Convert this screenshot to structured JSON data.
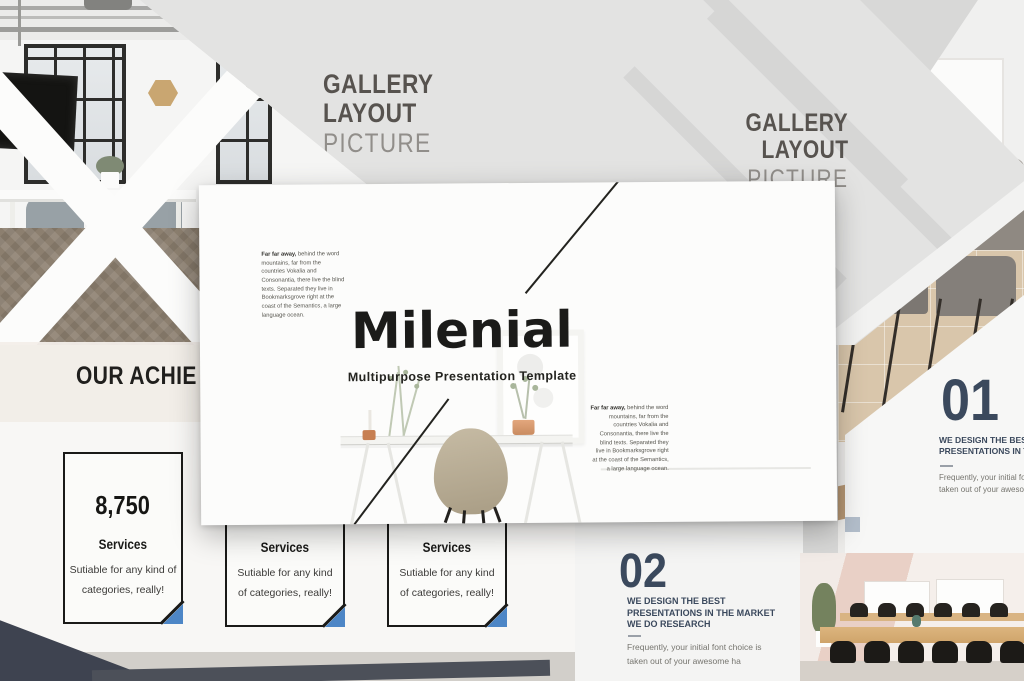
{
  "collage": {
    "gallery_left": {
      "line1": "GALLERY",
      "line2": "LAYOUT",
      "line3": "PICTURE"
    },
    "gallery_right": {
      "line1": "GALLERY",
      "line2": "LAYOUT",
      "line3": "PICTURE"
    },
    "main": {
      "title": "Milenial",
      "subtitle": "Multipurpose Presentation Template",
      "para_lead": "Far far away,",
      "para_body": " behind the word mountains, far from the countries Vokalia and Consonantia, there live the blind texts. Separated they live in Bookmarksgrove right at the coast of the Semantics, a large language ocean."
    },
    "achievements": {
      "title": "OUR ACHIE",
      "cards": [
        {
          "number": "8,750",
          "heading": "Services",
          "line1": "Sutiable for any kind of",
          "line2": "categories, really!"
        },
        {
          "heading": "Services",
          "line1": "Sutiable for any kind",
          "line2": "of categories, really!"
        },
        {
          "heading": "Services",
          "line1": "Sutiable for any kind",
          "line2": "of categories, really!"
        }
      ]
    },
    "block01": {
      "number": "01",
      "h1": "WE DESIGN THE BEST",
      "h2": "PRESENTATIONS IN THE",
      "b1": "Frequently, your initial font choice",
      "b2": "taken out of your awesome ha"
    },
    "block02": {
      "number": "02",
      "h1": "WE DESIGN THE BEST",
      "h2": "PRESENTATIONS IN THE MARKET",
      "h3": "WE DO RESEARCH",
      "b1": "Frequently, your initial font choice is",
      "b2": "taken out of your awesome ha"
    },
    "colors": {
      "accent_blue": "#4d86c6",
      "navy": "#3b495d",
      "ink": "#1b1b19",
      "slide_gray": "#e3e3e2"
    }
  }
}
